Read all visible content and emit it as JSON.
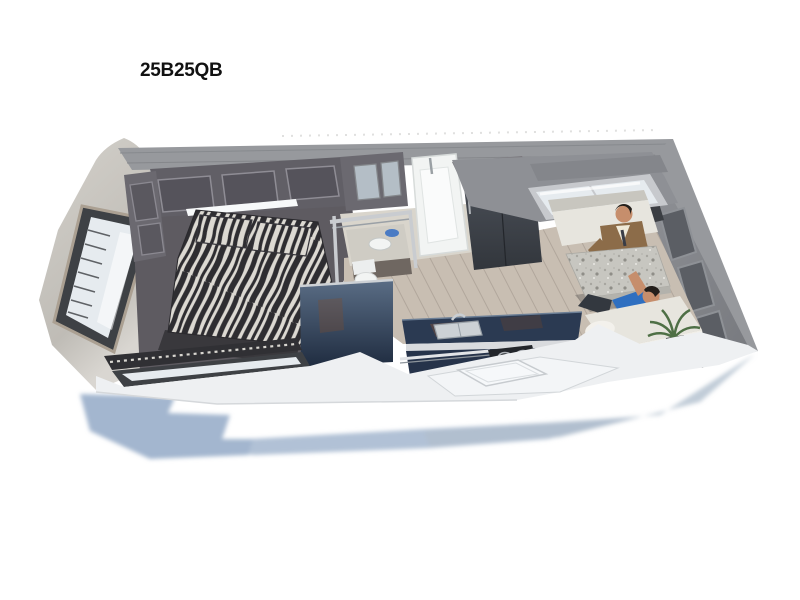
{
  "page": {
    "title": "25B25QB"
  },
  "floorplan": {
    "name": "travel-trailer-isometric-floorplan",
    "rooms": [
      "bedroom",
      "bathroom",
      "kitchen",
      "dinette"
    ],
    "colors": {
      "title": "#111111",
      "shadow_blue": "#a3b6cf",
      "shadow_gray": "#b2bfce",
      "wall_top": "#97999d",
      "wall_face": "#8e9095",
      "cap_light": "#d4d1cb",
      "cap_dark": "#bfbcb6",
      "cabinet_dark": "#615f66",
      "cabinet_panel": "#55535b",
      "wardrobe": "#6b6970",
      "led": "#f7f9fa",
      "zebra_bg": "#dcd9d2",
      "zebra_stripe": "#2e2d31",
      "bed_base": "#39383c",
      "carpet": "#5e5b61",
      "wood_floor": "#c8beb2",
      "wood_line": "#b1a79c",
      "bath_white": "#f2f4f3",
      "bath_platform": "#d9d5cc",
      "slate_front": "#3f444b",
      "slate_top": "#7b797e",
      "navy_panel_top": "#5a6d85",
      "navy_panel_bot": "#1f2c40",
      "navy_counter": "#2b3a52",
      "chrome": "#d9dbde",
      "white_band": "#eef0f2",
      "bench_cream": "#e7e5de",
      "granite": "#c7c6c0",
      "jacket_brown": "#8c6c49",
      "shirt_blue": "#2f6fc0",
      "skin": "#c68e6c",
      "hair": "#241f1b",
      "plant_green": "#4e6f45",
      "window_glass": "#e6ebef",
      "window_frame": "#3e4145",
      "mirror": "#b4bec6"
    }
  }
}
